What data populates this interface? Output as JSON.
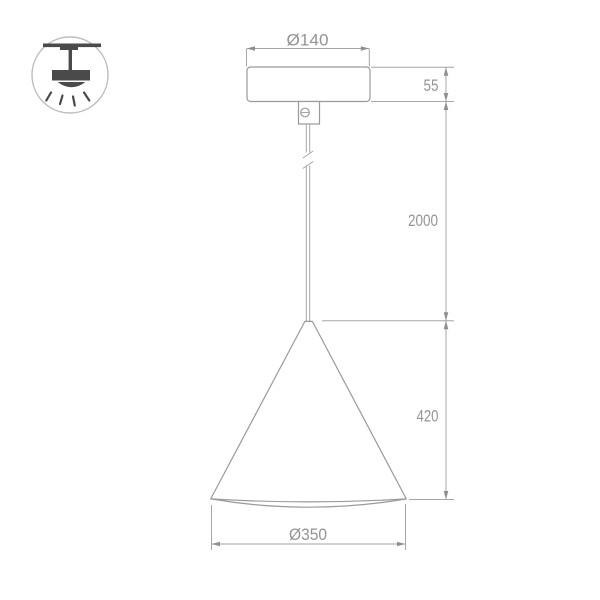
{
  "icon": {
    "type": "ceiling-pendant-light-icon"
  },
  "dimensions": {
    "canopy_diameter": "Ø140",
    "canopy_height": "55",
    "suspension_length": "2000",
    "shade_height": "420",
    "shade_diameter": "Ø350"
  },
  "colors": {
    "background": "#ffffff",
    "drawing_line": "#9a9a9a",
    "dimension_line": "#a6a6a6",
    "dimension_text": "#949494",
    "icon_fill": "#4a4a4a",
    "icon_ring": "#bdbdbd"
  }
}
